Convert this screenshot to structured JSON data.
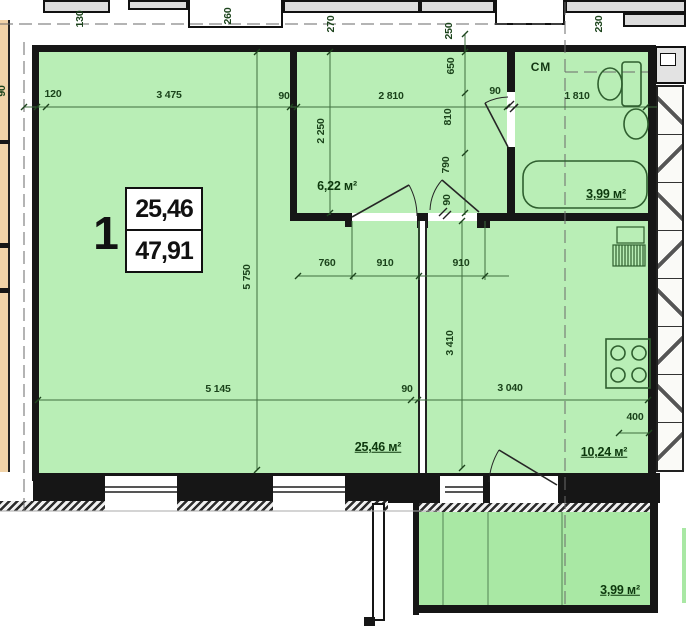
{
  "plan_type": "apartment-floor-plan",
  "plate": {
    "number": "1",
    "living_area": "25,46",
    "total_area": "47,91"
  },
  "areas": {
    "hall": "6,22 м²",
    "bathroom": "3,99 м²",
    "living": "25,46 м²",
    "kitchen": "10,24 м²",
    "balcony": "3,99 м²"
  },
  "labels": {
    "washing_machine": "СМ"
  },
  "dims": {
    "d130": "130",
    "d260": "260",
    "d270": "270",
    "d230": "230",
    "d250": "250",
    "d650": "650",
    "d810": "810",
    "d790": "790",
    "d90c": "90",
    "d2250": "2 250",
    "d5750": "5 750",
    "d3410": "3 410",
    "d120": "120",
    "d3475": "3 475",
    "d90a": "90",
    "d2810": "2 810",
    "d90b": "90",
    "d1810": "1 810",
    "d760": "760",
    "d910a": "910",
    "d910b": "910",
    "d5145": "5 145",
    "d90d": "90",
    "d3040": "3 040",
    "d400": "400",
    "d90left": "90"
  },
  "colors": {
    "room_fill": "#b9eeb6",
    "balcony_fill": "#a9e8a4",
    "wall": "#161616",
    "dim_line": "#3f6f3f",
    "dim_text": "#1b431b",
    "area_text": "#0d380d",
    "neighbor_tan": "#f1d3a8",
    "neighbor_gray": "#dcdcdc"
  }
}
